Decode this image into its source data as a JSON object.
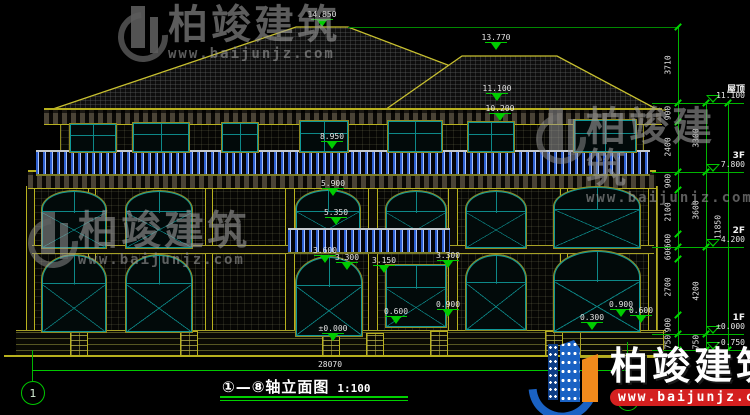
{
  "drawing": {
    "title": "①—⑧轴立面图",
    "scale": "1:100",
    "total_width_dim": "28070",
    "axis_start": "1",
    "axis_end": "8"
  },
  "levels": [
    {
      "name": "屋顶",
      "elev": "11.100",
      "y": 103
    },
    {
      "name": "3F",
      "elev": "7.800",
      "y": 172
    },
    {
      "name": "2F",
      "elev": "4.200",
      "y": 247
    },
    {
      "name": "1F",
      "elev": "±0.000",
      "y": 334
    },
    {
      "name": "",
      "elev": "-0.750",
      "y": 350
    }
  ],
  "dim_chains": [
    {
      "x": 678,
      "segments": [
        {
          "label": "3710",
          "y1": 27,
          "y2": 103
        },
        {
          "label": "900",
          "y1": 103,
          "y2": 122
        },
        {
          "label": "2400",
          "y1": 122,
          "y2": 172
        },
        {
          "label": "900",
          "y1": 172,
          "y2": 190
        },
        {
          "label": "2100",
          "y1": 190,
          "y2": 234
        },
        {
          "label": "600",
          "y1": 234,
          "y2": 247
        },
        {
          "label": "600",
          "y1": 247,
          "y2": 259
        },
        {
          "label": "2700",
          "y1": 259,
          "y2": 315
        },
        {
          "label": "900",
          "y1": 315,
          "y2": 334
        },
        {
          "label": "750",
          "y1": 334,
          "y2": 350
        }
      ]
    },
    {
      "x": 706,
      "segments": [
        {
          "label": "3300",
          "y1": 103,
          "y2": 172
        },
        {
          "label": "3600",
          "y1": 172,
          "y2": 247
        },
        {
          "label": "4200",
          "y1": 247,
          "y2": 334
        },
        {
          "label": "750",
          "y1": 334,
          "y2": 350
        }
      ]
    },
    {
      "x": 728,
      "segments": [
        {
          "label": "11850",
          "y1": 103,
          "y2": 350
        }
      ]
    }
  ],
  "facade_markers": [
    {
      "value": "14.850",
      "x": 322,
      "y": 27
    },
    {
      "value": "13.770",
      "x": 496,
      "y": 50
    },
    {
      "value": "11.100",
      "x": 497,
      "y": 101
    },
    {
      "value": "10.200",
      "x": 500,
      "y": 121
    },
    {
      "value": "8.950",
      "x": 332,
      "y": 149
    },
    {
      "value": "5.900",
      "x": 333,
      "y": 196
    },
    {
      "value": "5.350",
      "x": 336,
      "y": 225
    },
    {
      "value": "3.600",
      "x": 325,
      "y": 263
    },
    {
      "value": "3.300",
      "x": 347,
      "y": 270
    },
    {
      "value": "3.150",
      "x": 384,
      "y": 273
    },
    {
      "value": "3.300",
      "x": 448,
      "y": 268
    },
    {
      "value": "0.600",
      "x": 396,
      "y": 324
    },
    {
      "value": "0.900",
      "x": 448,
      "y": 317
    },
    {
      "value": "0.300",
      "x": 592,
      "y": 330
    },
    {
      "value": "0.900",
      "x": 621,
      "y": 317
    },
    {
      "value": "0.600",
      "x": 641,
      "y": 323
    },
    {
      "value": "±0.000",
      "x": 333,
      "y": 341
    }
  ],
  "watermark": {
    "brand": "柏竣建筑",
    "url": "www.baijunjz.com"
  }
}
